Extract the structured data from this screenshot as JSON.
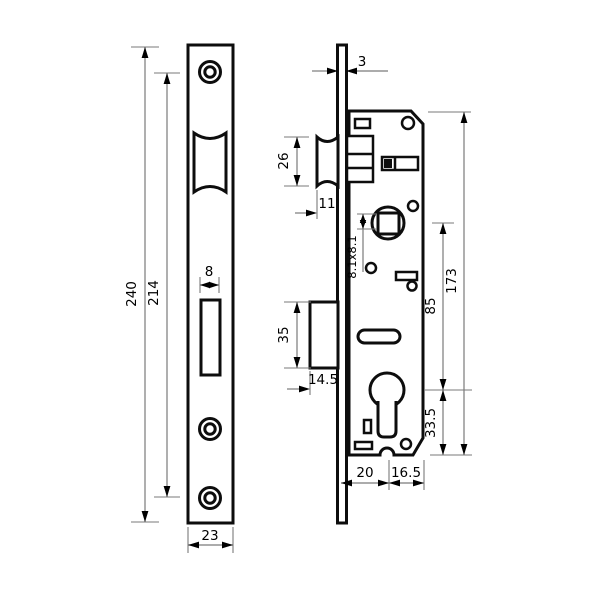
{
  "colors": {
    "background": "#ffffff",
    "outline": "#0d0d0d",
    "dimension_lines": "#7a7a7a",
    "text": "#000000"
  },
  "front_view": {
    "dims": {
      "overall_height": "240",
      "screw_hole_spacing": "214",
      "deadbolt_slot_width": "8",
      "plate_width": "23"
    }
  },
  "side_view": {
    "dims": {
      "faceplate_thickness": "3",
      "latch_height": "26",
      "latch_protrusion": "11",
      "follower_square": "8.1x8.1",
      "follower_to_cylinder": "85",
      "body_height": "173",
      "deadbolt_height": "35",
      "deadbolt_protrusion": "14.5",
      "cylinder_to_bottom": "33.5",
      "backset": "20",
      "cylinder_to_rear": "16.5"
    }
  }
}
